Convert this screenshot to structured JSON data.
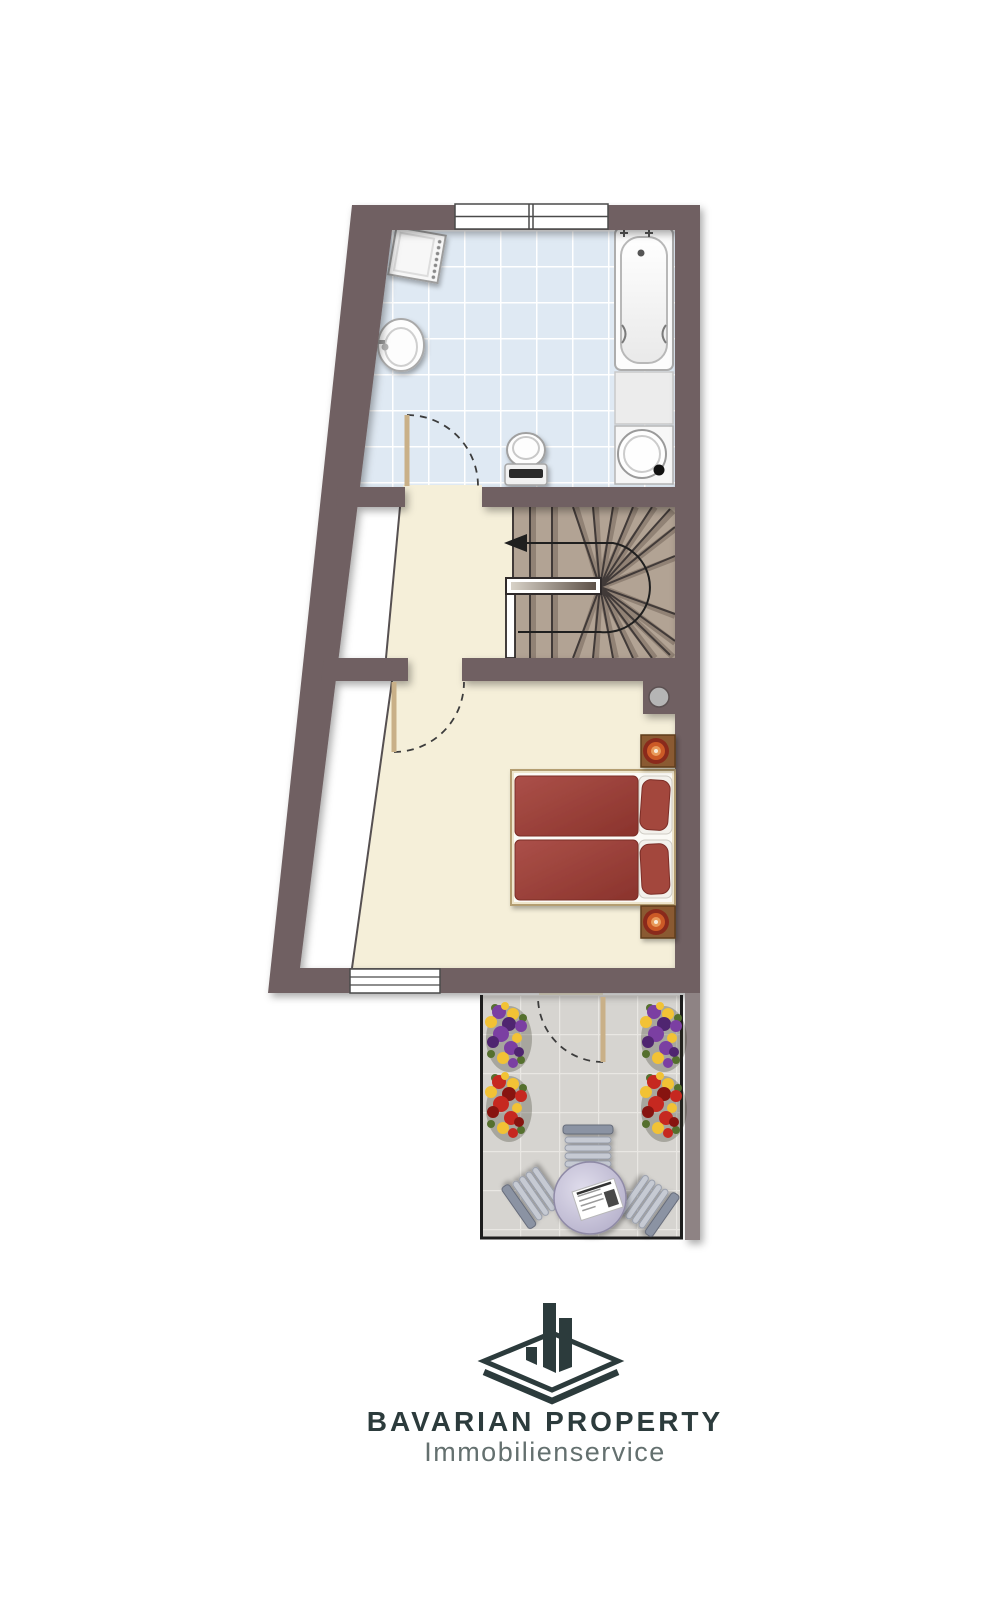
{
  "brand": {
    "title": "BAVARIAN PROPERTY",
    "subtitle": "Immobilienservice",
    "logo_icon": "isometric-platform-with-three-towers"
  },
  "palette": {
    "wall": "#6f6162",
    "neighbor_wall": "#8e8384",
    "floor_cream": "#f5efd9",
    "bath_tile": "#dfe9f3",
    "terrace_tile": "#d6d4d0",
    "stair_tread": "#b2a394",
    "duvet_red": "#9d4239",
    "nightstand_brown": "#8a5a30",
    "logo_dark": "#2c3b3c",
    "logo_gray": "#64706f",
    "flower_purple": "#7b3fa2",
    "flower_red": "#c62820",
    "flower_yellow": "#f2c235"
  },
  "plan": {
    "type": "apartment-floor-plan",
    "rooms": [
      {
        "id": "bathroom",
        "floor": "light-blue-tiles",
        "windows": 1,
        "fixtures": [
          "radiator",
          "washbasin",
          "toilet",
          "bathtub",
          "shelf",
          "washing-machine",
          "door"
        ]
      },
      {
        "id": "hallway",
        "floor": "cream",
        "fixtures": []
      },
      {
        "id": "staircase",
        "kind": "winder-stairs",
        "direction_arrow": "left",
        "fixtures": [
          "handrail"
        ]
      },
      {
        "id": "bedroom",
        "floor": "cream",
        "windows": 1,
        "fixtures": [
          "double-bed",
          "pillow",
          "pillow",
          "nightstand",
          "nightstand",
          "bedside-lamp",
          "bedside-lamp",
          "chimney-flue",
          "door"
        ]
      },
      {
        "id": "terrace",
        "floor": "gray-tiles",
        "fixtures": [
          "flower-planter",
          "flower-planter",
          "flower-planter",
          "flower-planter",
          "round-table",
          "newspaper",
          "garden-chair",
          "garden-chair",
          "garden-chair",
          "door"
        ]
      }
    ],
    "door_count": 4,
    "window_count": 2
  }
}
